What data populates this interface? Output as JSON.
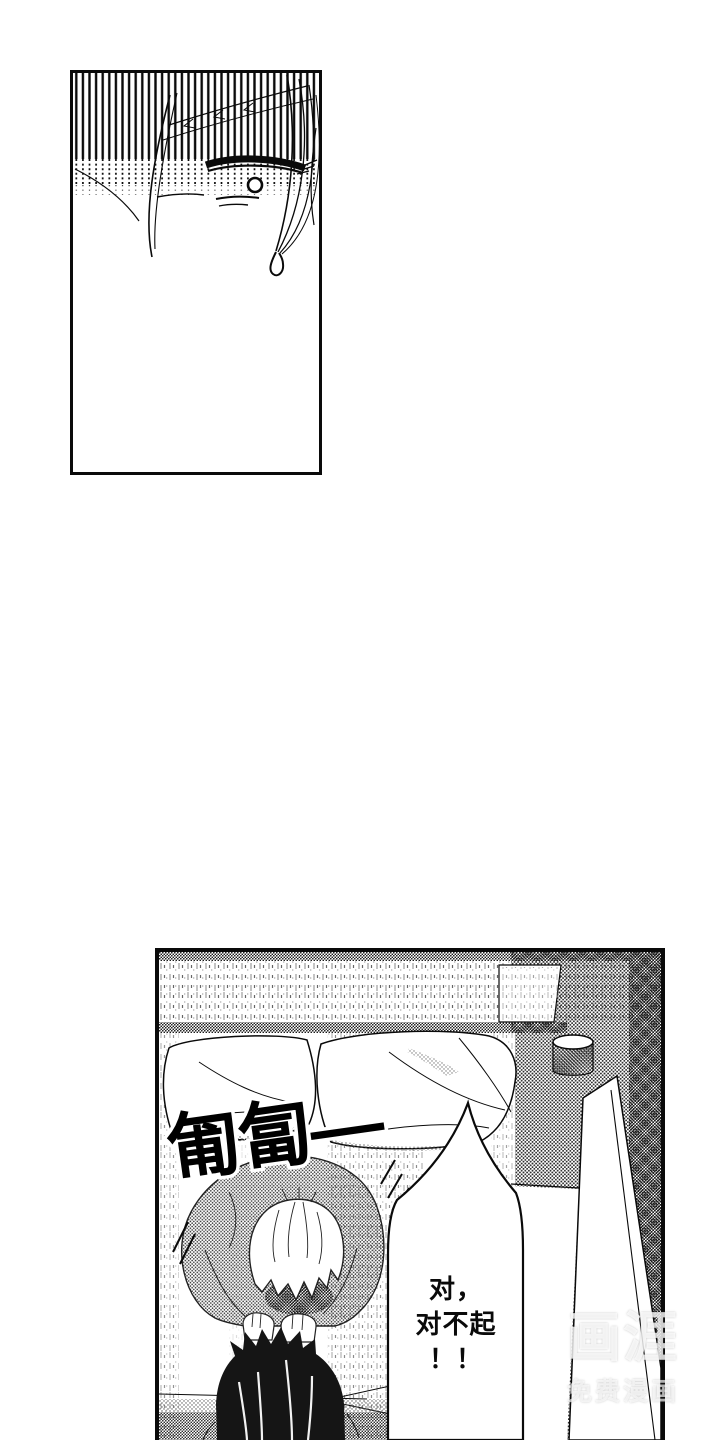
{
  "page": {
    "type": "manga page"
  },
  "panel_top": {
    "description": "Close-up of an eye with a sweat drop under vertical speed lines"
  },
  "panel_bottom": {
    "description": "A white-haired person bows deeply in apology toward a dark-haired person on a bed"
  },
  "sfx": {
    "text": "匍匐—"
  },
  "speech_bubble": {
    "line1": "对，",
    "line2": "对不起",
    "line3": "！！"
  },
  "watermark": {
    "logo": "画涯",
    "caption": "免费漫画"
  },
  "colors": {
    "ink": "#0a0a0a",
    "paper": "#ffffff"
  }
}
